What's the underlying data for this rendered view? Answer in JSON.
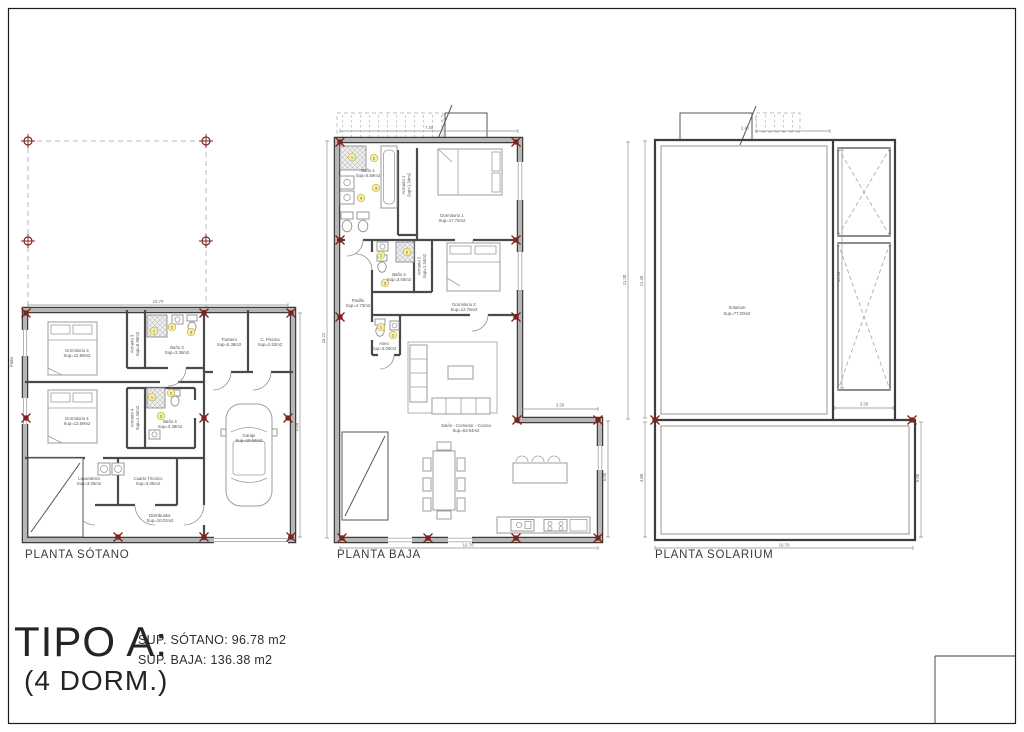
{
  "colors": {
    "wall_edge": "#3d3d3d",
    "wall_core": "#b6b6b6",
    "marker_red": "#7e231c",
    "key_yellow": "#f5efa3",
    "dim_gray": "#8f8f8f"
  },
  "title_block": {
    "title": "TIPO A:",
    "subtitle": "(4 DORM.)",
    "sup_lines": [
      "SUP. SÓTANO: 96.78 m2",
      "SUP. BAJA: 136.38 m2"
    ]
  },
  "plans": {
    "sotano": {
      "label": "PLANTA SÓTANO",
      "dims": {
        "top": "10.70",
        "right": "9.04"
      },
      "rooms": {
        "dormitorio3": {
          "name": "Dormitorio 3",
          "sup": "Sup=12.58m2"
        },
        "armario3": {
          "name": "Armario 3",
          "sup": "Sup=0.96m2"
        },
        "bano3": {
          "name": "Baño 3",
          "sup": "Sup=3.36m2"
        },
        "trastero": {
          "name": "Trastero",
          "sup": "Sup=5.38m2"
        },
        "cpiscina": {
          "name": "C. Piscina",
          "sup": "Sup=2.52m2"
        },
        "dormitorio4": {
          "name": "Dormitorio 4",
          "sup": "Sup=12.69m2"
        },
        "armario4": {
          "name": "Armario 4",
          "sup": "Sup=1.34m2"
        },
        "bano4": {
          "name": "Baño 4",
          "sup": "Sup=3.38m2"
        },
        "garaje": {
          "name": "Garaje",
          "sup": "Sup=19.66m2"
        },
        "lavanderia": {
          "name": "Lavandería",
          "sup": "Sup=3.05m2"
        },
        "cuartotecnico": {
          "name": "Cuarto Técnico",
          "sup": "Sup=3.05m2"
        },
        "distribuidor": {
          "name": "Distribuidor",
          "sup": "Sup=10.02m2"
        },
        "patio": {
          "name": "Patio"
        }
      },
      "fixture_keys": {
        "bano3": [
          "1",
          "2",
          "3"
        ],
        "bano4": [
          "1",
          "2",
          "3"
        ]
      }
    },
    "baja": {
      "label": "PLANTA BAJA",
      "dims": {
        "stairs": "7.40",
        "left": "16.22",
        "right": "11.30",
        "step": "3.30",
        "lower_right": "5.00",
        "bottom": "10.70"
      },
      "rooms": {
        "bano1": {
          "name": "Baño 1",
          "sup": "Sup=6.59m2"
        },
        "armario1": {
          "name": "Armario 1",
          "sup": "Sup=1.34m2"
        },
        "dormitorio1": {
          "name": "Dormitorio 1",
          "sup": "Sup=17.76m2"
        },
        "bano2": {
          "name": "Baño 2",
          "sup": "Sup=3.60m2"
        },
        "armario2": {
          "name": "Armario 2",
          "sup": "Sup=1.34m2"
        },
        "dormitorio2": {
          "name": "Dormitorio 2",
          "sup": "Sup=12.76m2"
        },
        "pasillo": {
          "name": "Pasillo",
          "sup": "Sup=4.73m2"
        },
        "aseo": {
          "name": "Aseo",
          "sup": "Sup=3.00m2"
        },
        "salon": {
          "name": "Salón - Comedor - Cocina",
          "sup": "Sup=63.94m2"
        }
      },
      "fixture_keys": {
        "bano1": [
          "1",
          "2",
          "3",
          "4"
        ],
        "bano2": [
          "1",
          "2",
          "3"
        ],
        "aseo": [
          "1",
          "2"
        ]
      }
    },
    "solarium": {
      "label": "PLANTA SOLARIUM",
      "dims": {
        "stairs": "2.40",
        "left": "11.40",
        "inner": "11.30",
        "step": "3.30",
        "lower_left": "4.80",
        "lower_right": "5.00",
        "bottom": "10.70"
      },
      "rooms": {
        "solarium": {
          "name": "Solarium",
          "sup": "Sup=77.00m2"
        }
      }
    }
  }
}
